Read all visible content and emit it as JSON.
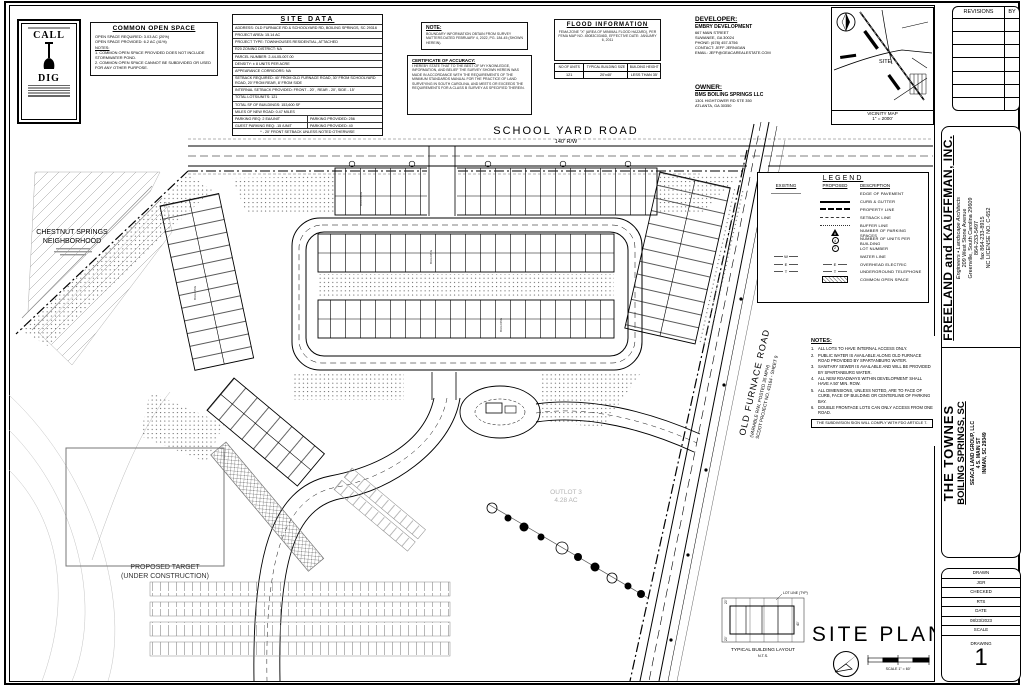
{
  "sheet": {
    "drawing_title": "SITE PLAN",
    "drawing_number": "1",
    "scale_text": "SCALE 1\" = 60'"
  },
  "poster": {
    "line1": "CALL",
    "line2": "DIG"
  },
  "common_open_space": {
    "title": "COMMON OPEN SPACE",
    "line1": "OPEN SPACE REQUIRED: 3.03 AC (20%)",
    "line2": "OPEN SPACE PROVIDED: 6.2 AC (41%)",
    "notes_title": "NOTES:",
    "note1": "1.  COMMON OPEN SPACE PROVIDED DOES NOT INCLUDE STORMWATER POND.",
    "note2": "2.  COMMON OPEN SPACE CANNOT BE SUBDIVIDED OR USED FOR ANY OTHER PURPOSE."
  },
  "site_data": {
    "title": "SITE DATA",
    "rows": [
      "ADDRESS: OLD FURNACE RD & SCHOOLYARD RD, BOILING SPRINGS, SC 29316",
      "PROJECT AREA: 15.14 AC",
      "PROJECT TYPE: TOWNHOUSES RESIDENTIAL, ATTACHED",
      "R20 ZONING DISTRICT: NA",
      "PARCEL NUMBER: 2-44-05-007.00",
      "DENSITY: ± 8 UNITS PER ACRE",
      "APPEARANCE CORRIDORS: NA",
      "SETBACK REQUIRED:  40' FROM OLD FURNACE ROAD,  30' FROM SCHOOLYARD ROAD,  20' FROM REAR,  8' FROM SIDE",
      "INTERNAL SETBACK PROVIDED:  FRONT - 20' , REAR - 20', SIDE - 15'",
      "TOTAL LOTS/UNITS: 121",
      "TOTAL SF OF BUILDINGS: 153,600 SF",
      "MILES OF NEW ROAD: 0.47 MILES"
    ],
    "parking_left": "PARKING REQ: 2 EA/UNIT",
    "parking_right": "PARKING PROVIDED: 256",
    "guest_left": "GUEST PARKING REQ: .15 /UNIT",
    "guest_right": "PARKING PROVIDED: 40",
    "footnote": "* - 20' FRONT SETBACK UNLESS NOTED OTHERWISE"
  },
  "note_panel": {
    "title": "NOTE:",
    "body": "BOUNDARY INFORMATION OBTAIN FROM SURVEY MATTERS DATED FEBRUARY 4, 2022, PG. 184-45 (SHOWN HEREIN)."
  },
  "certificate": {
    "title": "CERTIFICATE OF ACCURACY:",
    "body": "I HEREBY STATE THAT TO THE BEST OF MY KNOWLEDGE, INFORMATION, AND BELIEF THE SURVEY SHOWN HEREIN WAS MADE IN ACCORDANCE WITH THE REQUIREMENTS OF THE MINIMUM STANDARDS MANUAL FOR THE PRACTICE OF LAND SURVEYING IN SOUTH CAROLINA, AND MEETS OR EXCEEDS THE REQUIREMENTS FOR A CLASS B SURVEY AS SPECIFIED THEREIN."
  },
  "flood": {
    "title": "FLOOD INFORMATION",
    "body": "FEMA ZONE \"X\" (AREA OF MINIMAL FLOOD HAZARD), PER FEMA MAP NO. 45083C0346D, EFFECTIVE DATE: JANUARY 6, 2011",
    "headers": [
      "NO OF UNITS",
      "TYPICAL BUILDING SIZE",
      "BUILDING HEIGHT"
    ],
    "values": [
      "121",
      "20'x40'",
      "LESS THAN 35'"
    ]
  },
  "developer": {
    "title": "DEVELOPER:",
    "name": "EMBRY DEVELOPMENT",
    "addr1": "667 MAIN STREET",
    "addr2": "SUWANEE, GA 30024",
    "phone": "PHONE: (678) 457-5756",
    "contact": "CONTACT: JEFF JERNIGAN",
    "email": "EMAIL: JEFF@GEACAREALESTATE.COM"
  },
  "owner": {
    "title": "OWNER:",
    "name": "BMS BOILING SPRINGS LLC",
    "addr1": "1301 HIGHTOWER RD STE 350",
    "addr2": "ATLANTA, GA 30350"
  },
  "vicinity": {
    "caption": "VICINITY MAP",
    "scale": "1\" = 2000'",
    "site": "SITE"
  },
  "revisions": {
    "col1": "REVISIONS",
    "col2": "BY"
  },
  "firm": {
    "name": "FREELAND and KAUFFMAN, INC.",
    "tagline": "Engineers • Landscape Architects",
    "addr1": "209 West Stone Avenue",
    "addr2": "Greenville, South Carolina 29609",
    "phone": "864-233-5497",
    "fax": "fax 864-233-8915",
    "license": "NC LICENSE NO. C-652"
  },
  "project": {
    "title": "THE TOWNES",
    "location": "BOILING SPRINGS, SC",
    "client1": "SEACA LAND GROUP, LLC",
    "client2": "4 S. MAIN ST",
    "client3": "INMAN, SC 29349"
  },
  "stamp": {
    "drawn_label": "DRAWN",
    "drawn": "JGR",
    "checked_label": "CHECKED",
    "checked": "RTS",
    "date_label": "DATE",
    "date": "08/23/2023",
    "scale_label": "SCALE",
    "drawing_label": "DRAWING",
    "number": "1"
  },
  "legend": {
    "title": "LEGEND",
    "existing": "EXISTING",
    "proposed": "PROPOSED",
    "description": "DESCRIPTION",
    "rows": [
      {
        "d": "EDGE OF PAVEMENT"
      },
      {
        "d": "CURB & GUTTER"
      },
      {
        "d": "PROPERTY LINE"
      },
      {
        "d": "SETBACK LINE"
      },
      {
        "d": "BUFFER LINE"
      },
      {
        "d": "NUMBER OF PARKING SPACES",
        "sym": "#"
      },
      {
        "d": "NUMBER OF UNITS PER BUILDING",
        "sym": "4"
      },
      {
        "d": "LOT NUMBER",
        "sym": "2"
      },
      {
        "d": "WATER LINE",
        "sym": "W"
      },
      {
        "d": "OVERHEAD ELECTRIC",
        "sym": "E"
      },
      {
        "d": "UNDERGROUND TELEPHONE",
        "sym": "T"
      },
      {
        "d": "COMMON OPEN SPACE"
      }
    ]
  },
  "site_notes": {
    "title": "NOTES:",
    "items": [
      "ALL LOTS TO HAVE INTERNAL ACCESS ONLY.",
      "PUBLIC WATER IS AVAILABLE ALONG OLD FURNACE ROAD PROVIDED BY SPARTANBURG WATER.",
      "SANITARY SEWER IS AVAILABLE AND WILL BE PROVIDED BY SPARTANBURG WATER.",
      "ALL NEW ROADWAYS WITHIN DEVELOPMENT SHALL HAVE A 50' MIN. ROW.",
      "ALL DIMENSIONS, UNLESS NOTED, ARE TO FACE OF CURB, FACE OF BUILDING OR CENTERLINE OF PARKING BAY.",
      "DOUBLE FRONTAGE LOTS CAN ONLY ACCESS FROM ONE ROAD."
    ],
    "sign": "THE SUBDIVISION SIGN WILL COMPLY WITH FDO ARTICLE 7."
  },
  "plan": {
    "school_yard_road": "SCHOOL YARD ROAD",
    "school_yard_rw": "140' R/W",
    "old_furnace_l1": "OLD FURNACE ROAD",
    "old_furnace_l2": "(VARIABLE R/W, POSTED 35 MPH)",
    "old_furnace_l3": "SCDOT PROJECT NO. 43164 - SHEET 9",
    "chestnut_l1": "CHESTNUT SPRINGS",
    "chestnut_l2": "NEIGHBORHOOD",
    "target_l1": "PROPOSED TARGET",
    "target_l2": "(UNDER CONSTRUCTION)",
    "outlot_l1": "OUTLOT 3",
    "outlot_l2": "4.28 AC",
    "building": "BUILDING",
    "typ_layout": "TYPICAL BUILDING LAYOUT",
    "nts": "N.T.S.",
    "lot_line_typ": "LOT LINE (TYP)",
    "dim20": "20'",
    "dim40": "40'"
  }
}
